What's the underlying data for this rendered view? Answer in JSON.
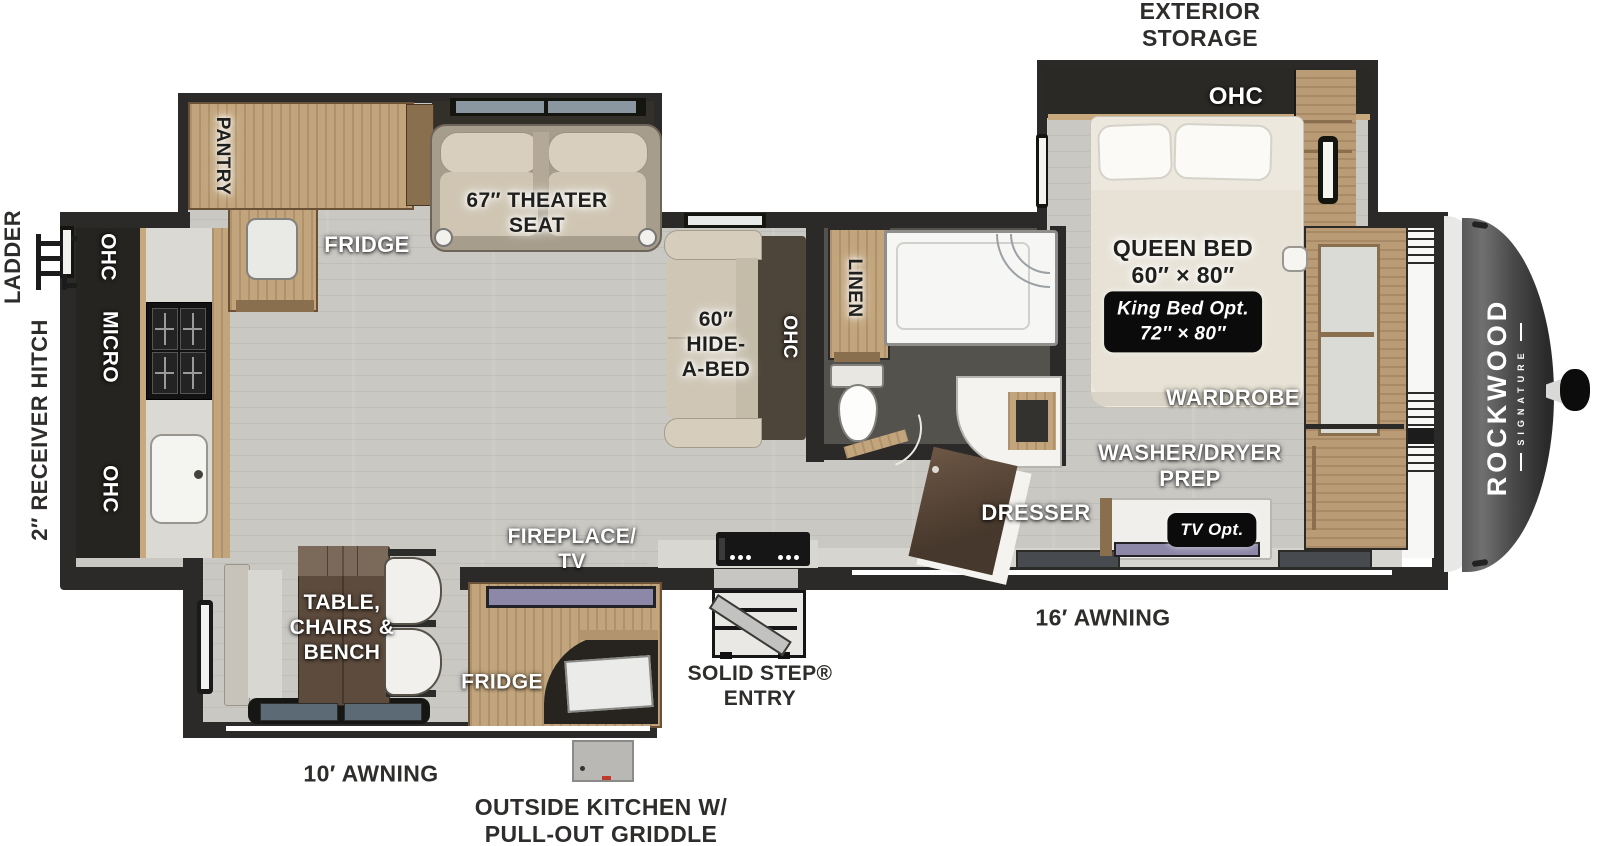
{
  "page": {
    "width": 1600,
    "height": 846,
    "background": "#ffffff",
    "description": "Rockwood Signature travel trailer floor plan, top view"
  },
  "brand": {
    "name": "ROCKWOOD",
    "sub": "SIGNATURE"
  },
  "colors": {
    "wall": "#2b2a28",
    "floor": "#c9c8c3",
    "wood": "#c2a57c",
    "dark_cabinet": "#262420",
    "sofa_beige": "#cfc6b5",
    "tv_accent": "#8d88a8",
    "badge_bg": "#0b0b0b",
    "cap_gray": "#4a4a4a",
    "bath_floor": "#54524d",
    "awning_line": "#ffffff"
  },
  "labels": [
    {
      "id": "exterior-storage",
      "text": "EXTERIOR\nSTORAGE",
      "x": 1200,
      "y": 25,
      "rot": 0,
      "style": "dark",
      "size": 23
    },
    {
      "id": "ohc-bedroom",
      "text": "OHC",
      "x": 1236,
      "y": 97,
      "rot": 0,
      "style": "white",
      "size": 24
    },
    {
      "id": "queen-bed",
      "text": "QUEEN BED\n60″ × 80″",
      "x": 1183,
      "y": 262,
      "rot": 0,
      "style": "glow",
      "size": 23
    },
    {
      "id": "king-bed-opt",
      "text": "King Bed Opt.\n72″ × 80″",
      "x": 1183,
      "y": 322,
      "rot": 0,
      "style": "badge",
      "size": 19
    },
    {
      "id": "wardrobe",
      "text": "WARDROBE",
      "x": 1233,
      "y": 398,
      "rot": 0,
      "style": "white",
      "size": 22
    },
    {
      "id": "washer-dryer-prep",
      "text": "WASHER/DRYER\nPREP",
      "x": 1190,
      "y": 466,
      "rot": 0,
      "style": "white",
      "size": 22
    },
    {
      "id": "dresser",
      "text": "DRESSER",
      "x": 1036,
      "y": 513,
      "rot": 0,
      "style": "white",
      "size": 22
    },
    {
      "id": "tv-opt",
      "text": "TV Opt.",
      "x": 1212,
      "y": 530,
      "rot": 0,
      "style": "badge",
      "size": 17
    },
    {
      "id": "linen",
      "text": "LINEN",
      "x": 854,
      "y": 288,
      "rot": 90,
      "style": "glow",
      "size": 19
    },
    {
      "id": "hide-a-bed",
      "text": "60″\nHIDE-\nA-BED",
      "x": 716,
      "y": 345,
      "rot": 0,
      "style": "glow",
      "size": 21
    },
    {
      "id": "ohc-sofa",
      "text": "OHC",
      "x": 789,
      "y": 337,
      "rot": 90,
      "style": "white",
      "size": 19
    },
    {
      "id": "theater-seat",
      "text": "67″ THEATER\nSEAT",
      "x": 537,
      "y": 214,
      "rot": 0,
      "style": "glow",
      "size": 21
    },
    {
      "id": "fridge-main",
      "text": "FRIDGE",
      "x": 367,
      "y": 245,
      "rot": 0,
      "style": "white",
      "size": 22
    },
    {
      "id": "pantry",
      "text": "PANTRY",
      "x": 222,
      "y": 156,
      "rot": 90,
      "style": "glow",
      "size": 19
    },
    {
      "id": "ohc-kitchen-top",
      "text": "OHC",
      "x": 107,
      "y": 257,
      "rot": 90,
      "style": "white",
      "size": 21
    },
    {
      "id": "micro",
      "text": "MICRO",
      "x": 109,
      "y": 347,
      "rot": 90,
      "style": "white",
      "size": 21
    },
    {
      "id": "ohc-kitchen-bottom",
      "text": "OHC",
      "x": 109,
      "y": 489,
      "rot": 90,
      "style": "white",
      "size": 21
    },
    {
      "id": "ladder",
      "text": "LADDER",
      "x": 13,
      "y": 257,
      "rot": -90,
      "style": "dark",
      "size": 22
    },
    {
      "id": "receiver-hitch",
      "text": "2″ RECEIVER HITCH",
      "x": 40,
      "y": 430,
      "rot": -90,
      "style": "dark",
      "size": 22
    },
    {
      "id": "table-chairs-bench",
      "text": "TABLE,\nCHAIRS &\nBENCH",
      "x": 342,
      "y": 628,
      "rot": 0,
      "style": "white",
      "size": 21
    },
    {
      "id": "fireplace-tv",
      "text": "FIREPLACE/\nTV",
      "x": 572,
      "y": 550,
      "rot": 0,
      "style": "white",
      "size": 21
    },
    {
      "id": "fridge-outside",
      "text": "FRIDGE",
      "x": 502,
      "y": 683,
      "rot": 0,
      "style": "white",
      "size": 21
    },
    {
      "id": "awning-10",
      "text": "10′ AWNING",
      "x": 371,
      "y": 774,
      "rot": 0,
      "style": "dark",
      "size": 23
    },
    {
      "id": "awning-16",
      "text": "16′ AWNING",
      "x": 1103,
      "y": 618,
      "rot": 0,
      "style": "dark",
      "size": 23
    },
    {
      "id": "solid-step-entry",
      "text": "SOLID STEP®\nENTRY",
      "x": 760,
      "y": 687,
      "rot": 0,
      "style": "dark",
      "size": 21
    },
    {
      "id": "outside-kitchen",
      "text": "OUTSIDE KITCHEN W/\nPULL-OUT GRIDDLE",
      "x": 601,
      "y": 821,
      "rot": 0,
      "style": "dark",
      "size": 23
    }
  ]
}
